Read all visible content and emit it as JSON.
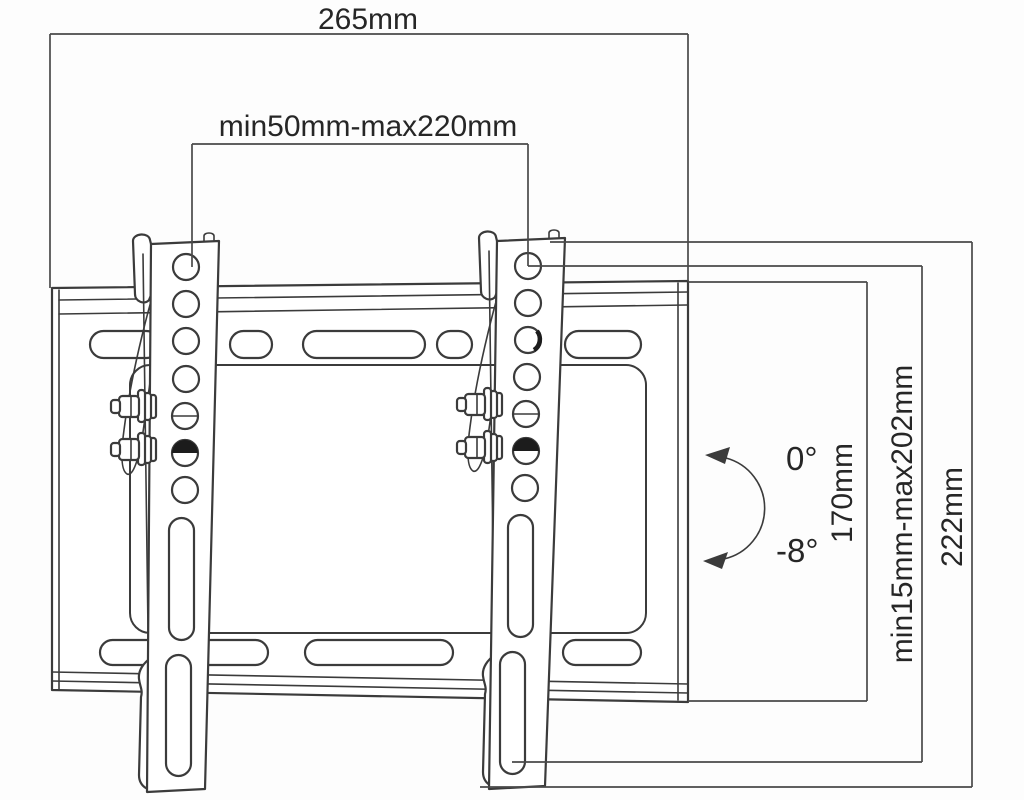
{
  "colors": {
    "background": "#fdfdfd",
    "line": "#3b3b3b",
    "dim_line": "#4a4a4a",
    "text": "#262626",
    "fill": "#ffffff",
    "dark_fill": "#1c1c1c"
  },
  "drawing": {
    "description": "Tilting TV wall-mount bracket dimension drawing",
    "dim_overall_width": "265mm",
    "dim_vesa_width_range": "min50mm-max220mm",
    "dim_plate_height": "170mm",
    "dim_vesa_height_range": "min15mm-max202mm",
    "dim_overall_height": "222mm",
    "tilt_upper": "0°",
    "tilt_lower": "-8°"
  }
}
